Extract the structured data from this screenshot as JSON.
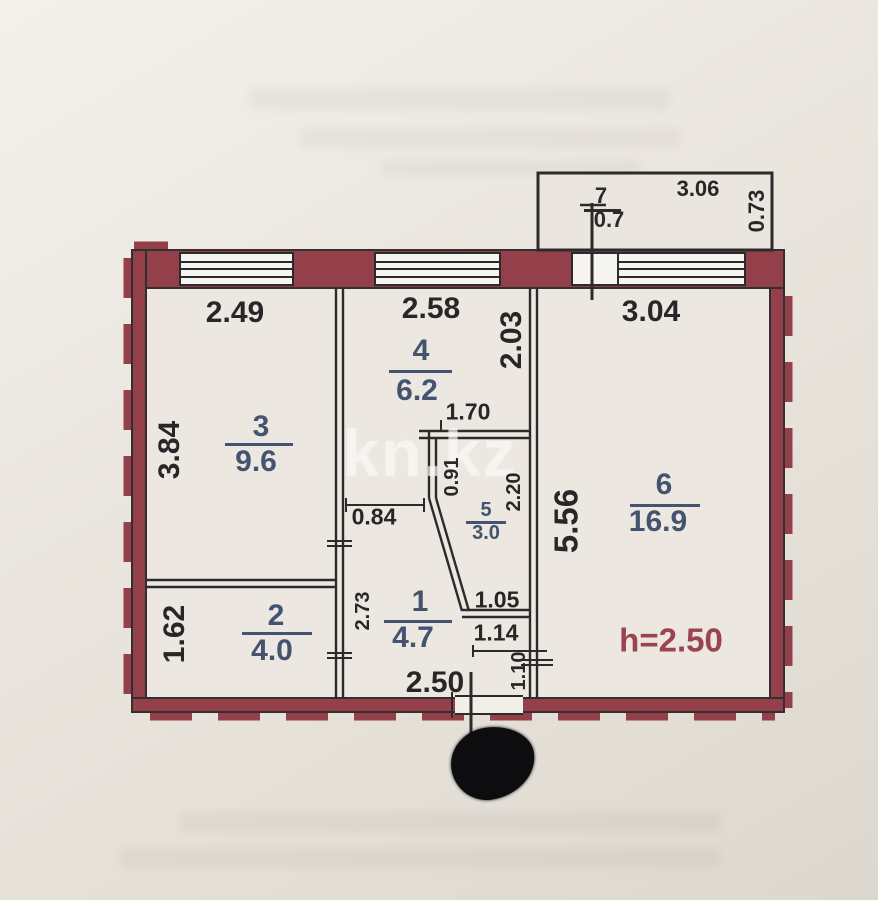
{
  "watermark": "kn.kz",
  "colors": {
    "wall_maroon": "#93404a",
    "line_black": "#2b2b2b",
    "label_blue": "#44536f",
    "dim_black": "#272727",
    "note_red": "#9c4350"
  },
  "rooms": [
    {
      "id": "room-3",
      "num": "3",
      "area": "9.6",
      "num_pos": [
        261,
        427
      ],
      "line": [
        225,
        293,
        443
      ],
      "area_pos": [
        256,
        462
      ],
      "size": 30
    },
    {
      "id": "room-2",
      "num": "2",
      "area": "4.0",
      "num_pos": [
        276,
        616
      ],
      "line": [
        242,
        312,
        632
      ],
      "area_pos": [
        272,
        651
      ],
      "size": 30
    },
    {
      "id": "room-4",
      "num": "4",
      "area": "6.2",
      "num_pos": [
        421,
        351
      ],
      "line": [
        389,
        452,
        370
      ],
      "area_pos": [
        417,
        391
      ],
      "size": 30
    },
    {
      "id": "room-1",
      "num": "1",
      "area": "4.7",
      "num_pos": [
        420,
        602
      ],
      "line": [
        384,
        452,
        620
      ],
      "area_pos": [
        413,
        638
      ],
      "size": 30
    },
    {
      "id": "room-5",
      "num": "5",
      "area": "3.0",
      "num_pos": [
        486,
        510
      ],
      "line": [
        466,
        506,
        521
      ],
      "area_pos": [
        486,
        533
      ],
      "size": 20
    },
    {
      "id": "room-6",
      "num": "6",
      "area": "16.9",
      "num_pos": [
        664,
        485
      ],
      "line": [
        630,
        700,
        504
      ],
      "area_pos": [
        658,
        522
      ],
      "size": 30
    },
    {
      "id": "room-7",
      "num": "7",
      "area": "0.7",
      "num_pos": [
        601,
        196
      ],
      "line": [
        584,
        621,
        209
      ],
      "area_pos": [
        609,
        220
      ],
      "size": 22,
      "color": "#2b2b2b"
    }
  ],
  "dimensions": [
    {
      "id": "dim-top-room3",
      "text": "2.49",
      "pos": [
        235,
        313
      ],
      "size": 30
    },
    {
      "id": "dim-top-room4",
      "text": "2.58",
      "pos": [
        431,
        309
      ],
      "size": 30
    },
    {
      "id": "dim-room4-depth",
      "text": "2.03",
      "pos": [
        512,
        340
      ],
      "rot": true,
      "size": 30
    },
    {
      "id": "dim-top-room6",
      "text": "3.04",
      "pos": [
        651,
        312
      ],
      "size": 30
    },
    {
      "id": "dim-room3-depth",
      "text": "3.84",
      "pos": [
        170,
        450
      ],
      "rot": true,
      "size": 30
    },
    {
      "id": "dim-room2-depth",
      "text": "1.62",
      "pos": [
        175,
        634
      ],
      "rot": true,
      "size": 30
    },
    {
      "id": "dim-room6-depth",
      "text": "5.56",
      "pos": [
        566,
        521
      ],
      "rot": true,
      "size": 33
    },
    {
      "id": "dim-bath-width",
      "text": "1.70",
      "pos": [
        468,
        412
      ],
      "size": 23
    },
    {
      "id": "dim-door-084",
      "text": "0.84",
      "pos": [
        374,
        517
      ],
      "size": 23
    },
    {
      "id": "dim-bath-091",
      "text": "0.91",
      "pos": [
        452,
        477
      ],
      "rot": true,
      "size": 20
    },
    {
      "id": "dim-bath-220",
      "text": "2.20",
      "pos": [
        514,
        492
      ],
      "rot": true,
      "size": 20
    },
    {
      "id": "dim-hall-273",
      "text": "2.73",
      "pos": [
        363,
        611
      ],
      "rot": true,
      "size": 20
    },
    {
      "id": "dim-hall-105",
      "text": "1.05",
      "pos": [
        497,
        600
      ],
      "size": 23
    },
    {
      "id": "dim-hall-114",
      "text": "1.14",
      "pos": [
        496,
        633
      ],
      "size": 23
    },
    {
      "id": "dim-hall-110",
      "text": "1.10",
      "pos": [
        519,
        671
      ],
      "rot": true,
      "size": 20
    },
    {
      "id": "dim-entry-250",
      "text": "2.50",
      "pos": [
        435,
        683
      ],
      "size": 30
    },
    {
      "id": "dim-balcony-width",
      "text": "3.06",
      "pos": [
        698,
        189
      ],
      "size": 22
    },
    {
      "id": "dim-balcony-depth",
      "text": "0.73",
      "pos": [
        757,
        211
      ],
      "rot": true,
      "size": 22
    },
    {
      "id": "ceiling-height-note",
      "text": "h=2.50",
      "pos": [
        671,
        640
      ],
      "size": 33,
      "color": "#9c4350"
    }
  ]
}
